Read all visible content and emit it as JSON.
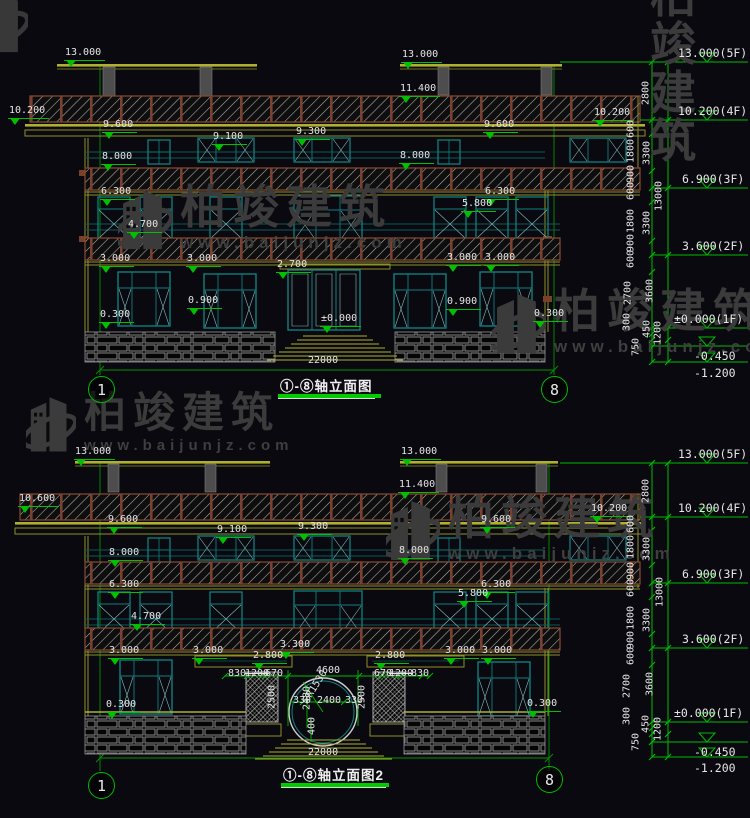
{
  "watermark": {
    "brand": "柏竣建筑",
    "url": "www.baijunjz.com"
  },
  "drawings": [
    {
      "id": "d1",
      "title": "①-⑧轴立面图",
      "axis_left": "1",
      "axis_right": "8",
      "total_width": "22000",
      "labels": [
        {
          "t": "13.000",
          "x": 64,
          "y": 47,
          "m": 1
        },
        {
          "t": "13.000",
          "x": 401,
          "y": 49,
          "m": 1
        },
        {
          "t": "11.400",
          "x": 399,
          "y": 83,
          "m": 1
        },
        {
          "t": "10.200",
          "x": 8,
          "y": 105,
          "m": 1
        },
        {
          "t": "10.200",
          "x": 593,
          "y": 107,
          "m": 1
        },
        {
          "t": "9.600",
          "x": 102,
          "y": 119,
          "m": 1
        },
        {
          "t": "9.600",
          "x": 483,
          "y": 119,
          "m": 1
        },
        {
          "t": "9.100",
          "x": 212,
          "y": 131,
          "m": 1
        },
        {
          "t": "9.300",
          "x": 295,
          "y": 126,
          "m": 1
        },
        {
          "t": "8.000",
          "x": 101,
          "y": 151,
          "m": 1
        },
        {
          "t": "8.000",
          "x": 399,
          "y": 150,
          "m": 1
        },
        {
          "t": "6.300",
          "x": 100,
          "y": 186,
          "m": 1
        },
        {
          "t": "6.300",
          "x": 484,
          "y": 186,
          "m": 1
        },
        {
          "t": "5.800",
          "x": 461,
          "y": 198,
          "m": 1
        },
        {
          "t": "4.700",
          "x": 127,
          "y": 219,
          "m": 1
        },
        {
          "t": "3.000",
          "x": 99,
          "y": 253,
          "m": 1
        },
        {
          "t": "3.000",
          "x": 186,
          "y": 253,
          "m": 1
        },
        {
          "t": "2.700",
          "x": 276,
          "y": 259,
          "m": 1
        },
        {
          "t": "3.000",
          "x": 446,
          "y": 252,
          "m": 1
        },
        {
          "t": "3.000",
          "x": 484,
          "y": 252,
          "m": 1
        },
        {
          "t": "0.900",
          "x": 187,
          "y": 295,
          "m": 1
        },
        {
          "t": "0.900",
          "x": 446,
          "y": 296,
          "m": 1
        },
        {
          "t": "0.300",
          "x": 99,
          "y": 309,
          "m": 1
        },
        {
          "t": "0.300",
          "x": 533,
          "y": 308,
          "m": 1
        },
        {
          "t": "±0.000",
          "x": 320,
          "y": 313,
          "m": 1
        },
        {
          "t": "22000",
          "x": 308,
          "y": 355
        },
        {
          "t": "13.000(5F)",
          "x": 678,
          "y": 46,
          "big": 1
        },
        {
          "t": "10.200(4F)",
          "x": 678,
          "y": 104,
          "big": 1
        },
        {
          "t": "6.900(3F)",
          "x": 682,
          "y": 172,
          "big": 1
        },
        {
          "t": "3.600(2F)",
          "x": 682,
          "y": 239,
          "big": 1
        },
        {
          "t": "±0.000(1F)",
          "x": 674,
          "y": 312,
          "big": 1
        },
        {
          "t": "-0.450",
          "x": 694,
          "y": 349,
          "big": 1
        },
        {
          "t": "-1.200",
          "x": 694,
          "y": 366,
          "big": 1
        },
        {
          "t": "2800",
          "x": 646,
          "y": 93,
          "r": 1
        },
        {
          "t": "600",
          "x": 631,
          "y": 129,
          "r": 1
        },
        {
          "t": "1800",
          "x": 631,
          "y": 151,
          "r": 1
        },
        {
          "t": "3300",
          "x": 647,
          "y": 153,
          "r": 1
        },
        {
          "t": "900",
          "x": 631,
          "y": 174,
          "r": 1
        },
        {
          "t": "600",
          "x": 631,
          "y": 191,
          "r": 1
        },
        {
          "t": "13000",
          "x": 659,
          "y": 196,
          "r": 1
        },
        {
          "t": "1800",
          "x": 631,
          "y": 221,
          "r": 1
        },
        {
          "t": "3300",
          "x": 647,
          "y": 223,
          "r": 1
        },
        {
          "t": "900",
          "x": 631,
          "y": 243,
          "r": 1
        },
        {
          "t": "600",
          "x": 631,
          "y": 259,
          "r": 1
        },
        {
          "t": "2700",
          "x": 628,
          "y": 293,
          "r": 1
        },
        {
          "t": "3600",
          "x": 650,
          "y": 291,
          "r": 1
        },
        {
          "t": "300",
          "x": 627,
          "y": 322,
          "r": 1
        },
        {
          "t": "450",
          "x": 647,
          "y": 329,
          "r": 1
        },
        {
          "t": "1200",
          "x": 658,
          "y": 333,
          "r": 1
        },
        {
          "t": "750",
          "x": 636,
          "y": 347,
          "r": 1
        }
      ]
    },
    {
      "id": "d2",
      "title": "①-⑧轴立面图2",
      "axis_left": "1",
      "axis_right": "8",
      "total_width": "22000",
      "labels": [
        {
          "t": "13.000",
          "x": 74,
          "y": 446,
          "m": 1
        },
        {
          "t": "13.000",
          "x": 400,
          "y": 446,
          "m": 1
        },
        {
          "t": "11.400",
          "x": 398,
          "y": 479,
          "m": 1
        },
        {
          "t": "10.600",
          "x": 18,
          "y": 493,
          "m": 1
        },
        {
          "t": "10.200",
          "x": 590,
          "y": 503,
          "m": 1
        },
        {
          "t": "9.600",
          "x": 107,
          "y": 514,
          "m": 1
        },
        {
          "t": "9.600",
          "x": 480,
          "y": 514,
          "m": 1
        },
        {
          "t": "9.100",
          "x": 216,
          "y": 524,
          "m": 1
        },
        {
          "t": "9.300",
          "x": 297,
          "y": 521,
          "m": 1
        },
        {
          "t": "8.000",
          "x": 108,
          "y": 547,
          "m": 1
        },
        {
          "t": "8.000",
          "x": 398,
          "y": 545,
          "m": 1
        },
        {
          "t": "6.300",
          "x": 108,
          "y": 579,
          "m": 1
        },
        {
          "t": "6.300",
          "x": 480,
          "y": 579,
          "m": 1
        },
        {
          "t": "5.800",
          "x": 457,
          "y": 588,
          "m": 1
        },
        {
          "t": "4.700",
          "x": 130,
          "y": 611,
          "m": 1
        },
        {
          "t": "3.000",
          "x": 108,
          "y": 645,
          "m": 1
        },
        {
          "t": "3.000",
          "x": 192,
          "y": 645,
          "m": 1
        },
        {
          "t": "3.300",
          "x": 279,
          "y": 639,
          "m": 1
        },
        {
          "t": "2.800",
          "x": 252,
          "y": 650,
          "m": 1
        },
        {
          "t": "2.800",
          "x": 374,
          "y": 650,
          "m": 1
        },
        {
          "t": "3.000",
          "x": 444,
          "y": 645,
          "m": 1
        },
        {
          "t": "3.000",
          "x": 481,
          "y": 645,
          "m": 1
        },
        {
          "t": "0.300",
          "x": 105,
          "y": 699,
          "m": 1
        },
        {
          "t": "0.300",
          "x": 526,
          "y": 698,
          "m": 1
        },
        {
          "t": "830",
          "x": 228,
          "y": 668
        },
        {
          "t": "1200",
          "x": 245,
          "y": 668,
          "strike": 1
        },
        {
          "t": "670",
          "x": 265,
          "y": 668
        },
        {
          "t": "4600",
          "x": 316,
          "y": 665
        },
        {
          "t": "670",
          "x": 374,
          "y": 668
        },
        {
          "t": "1200",
          "x": 389,
          "y": 668,
          "strike": 1
        },
        {
          "t": "830",
          "x": 411,
          "y": 668
        },
        {
          "t": "2500",
          "x": 272,
          "y": 697,
          "r": 1
        },
        {
          "t": "2500",
          "x": 362,
          "y": 697,
          "r": 1
        },
        {
          "t": "2480",
          "x": 307,
          "y": 698,
          "r": 1
        },
        {
          "t": "R1530",
          "x": 317,
          "y": 684,
          "diag": 1
        },
        {
          "t": "330",
          "x": 293,
          "y": 695
        },
        {
          "t": "2400",
          "x": 317,
          "y": 695
        },
        {
          "t": "330",
          "x": 345,
          "y": 695
        },
        {
          "t": "400",
          "x": 312,
          "y": 726,
          "r": 1
        },
        {
          "t": "22000",
          "x": 308,
          "y": 747
        },
        {
          "t": "13.000(5F)",
          "x": 678,
          "y": 447,
          "big": 1
        },
        {
          "t": "10.200(4F)",
          "x": 678,
          "y": 501,
          "big": 1
        },
        {
          "t": "6.900(3F)",
          "x": 682,
          "y": 567,
          "big": 1
        },
        {
          "t": "3.600(2F)",
          "x": 682,
          "y": 632,
          "big": 1
        },
        {
          "t": "±0.000(1F)",
          "x": 674,
          "y": 706,
          "big": 1
        },
        {
          "t": "-0.450",
          "x": 694,
          "y": 745,
          "big": 1
        },
        {
          "t": "-1.200",
          "x": 694,
          "y": 761,
          "big": 1
        },
        {
          "t": "2800",
          "x": 646,
          "y": 491,
          "r": 1
        },
        {
          "t": "600",
          "x": 631,
          "y": 524,
          "r": 1
        },
        {
          "t": "1800",
          "x": 631,
          "y": 547,
          "r": 1
        },
        {
          "t": "3300",
          "x": 647,
          "y": 549,
          "r": 1
        },
        {
          "t": "900",
          "x": 631,
          "y": 571,
          "r": 1
        },
        {
          "t": "600",
          "x": 631,
          "y": 588,
          "r": 1
        },
        {
          "t": "13000",
          "x": 660,
          "y": 592,
          "r": 1
        },
        {
          "t": "1800",
          "x": 631,
          "y": 618,
          "r": 1
        },
        {
          "t": "3300",
          "x": 647,
          "y": 620,
          "r": 1
        },
        {
          "t": "900",
          "x": 631,
          "y": 640,
          "r": 1
        },
        {
          "t": "600",
          "x": 631,
          "y": 656,
          "r": 1
        },
        {
          "t": "2700",
          "x": 627,
          "y": 686,
          "r": 1
        },
        {
          "t": "3600",
          "x": 650,
          "y": 684,
          "r": 1
        },
        {
          "t": "300",
          "x": 627,
          "y": 716,
          "r": 1
        },
        {
          "t": "450",
          "x": 646,
          "y": 724,
          "r": 1
        },
        {
          "t": "1200",
          "x": 658,
          "y": 729,
          "r": 1
        },
        {
          "t": "750",
          "x": 636,
          "y": 742,
          "r": 1
        }
      ]
    }
  ]
}
